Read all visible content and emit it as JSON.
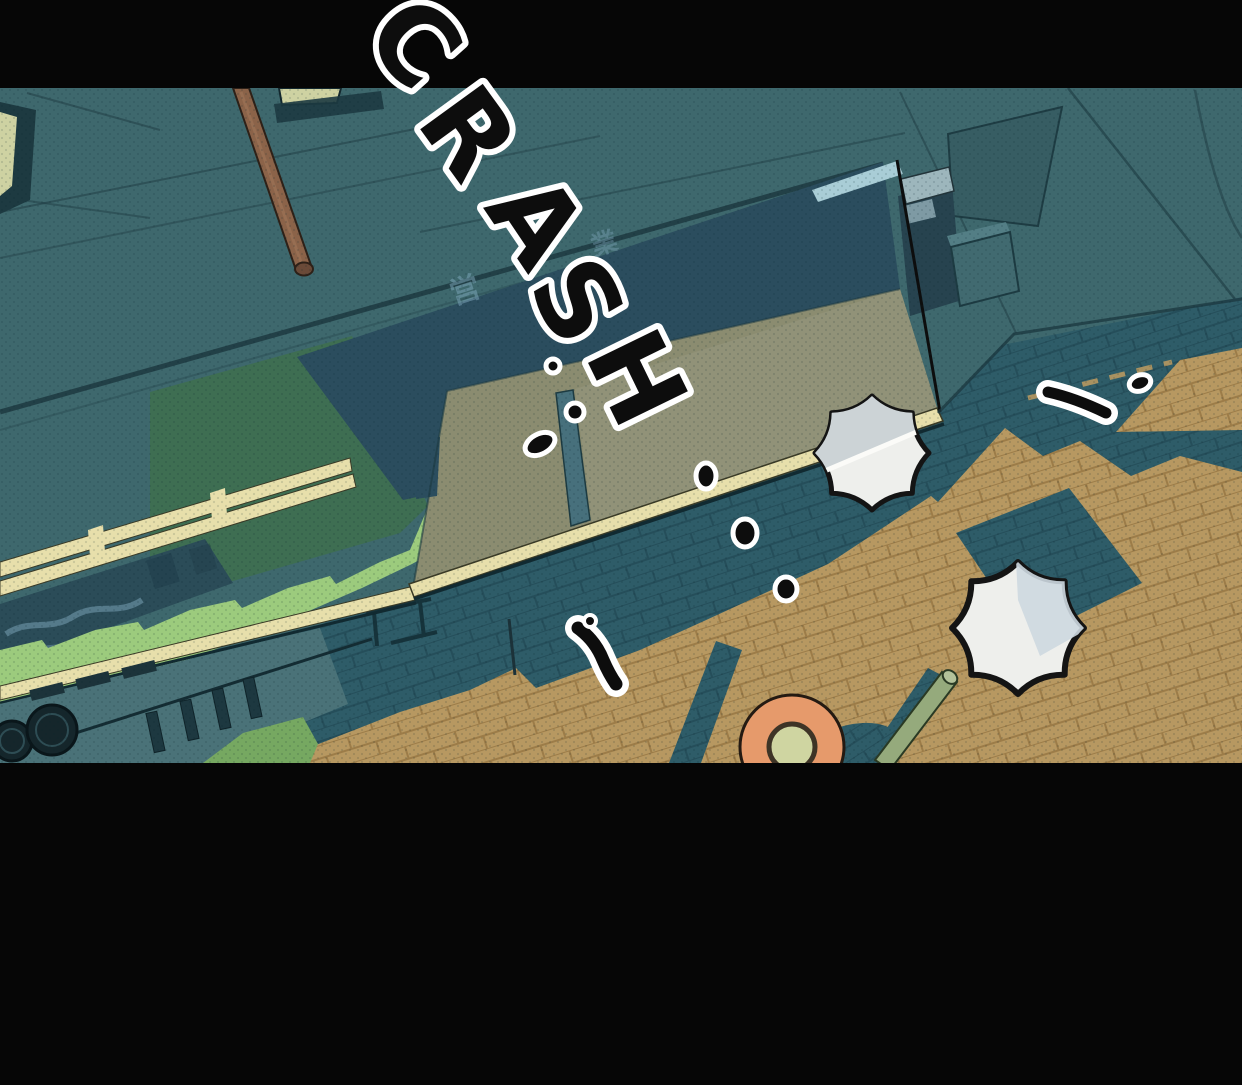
{
  "panel": {
    "description": "Top-down webtoon panel: night storefront with awnings, paved sidewalk, two parasols, round orange table, fallen green pole and ink droplets",
    "sfx": {
      "text": "CRASH",
      "letters": [
        "C",
        "R",
        "A",
        "S",
        "H"
      ]
    },
    "sign": {
      "glyphs": [
        "営",
        "業"
      ]
    }
  },
  "colors": {
    "ink": "#0d0d0d",
    "black-bar": "#060606",
    "teal-wall": "#3e686d",
    "teal-wall-dark": "#375d63",
    "line-dark": "#1d3a41",
    "window-pale": "#ced2a2",
    "pole-brown": "#8b6349",
    "navy-awning": "#2b4d5e",
    "trim-lightblue": "#a9cdd6",
    "khaki-awning": "#8b8c70",
    "khaki-awning-light": "#93947b",
    "cream-beam": "#e7dfab",
    "green-awning": "#3e6e52",
    "green-awning-light": "#9ccb7d",
    "sign-band": "#2b4c58",
    "sign-squiggle": "#7fa8bc",
    "roof-teal": "#4a7278",
    "grass-green": "#76a861",
    "pave-shadow": "#2e5c68",
    "pave-shadow-line": "#254e5a",
    "pave-tan": "#b79861",
    "pave-tan-line": "#9c7c48",
    "umbrella-white": "#eeefec",
    "umbrella-grey": "#ccd3d6",
    "umbrella-blue": "#cdd8e0",
    "table-orange": "#e69a6b",
    "table-center": "#cfd5a1",
    "pole-green": "#95aa7c",
    "fan-dark": "#15262b"
  }
}
